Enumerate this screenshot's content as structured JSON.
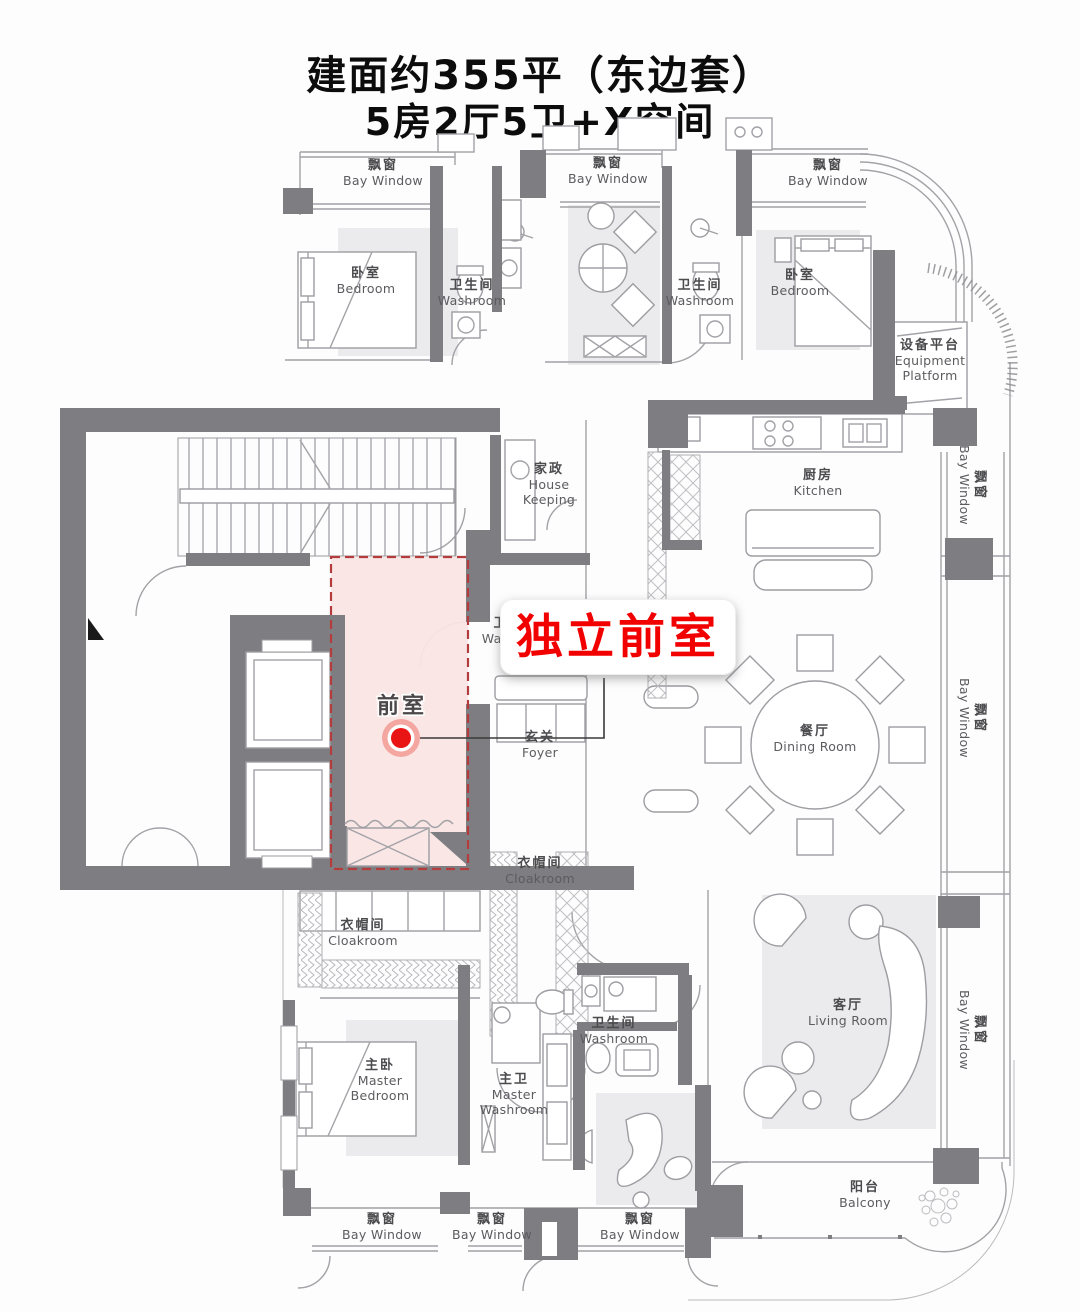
{
  "title": {
    "line1": "建面约355平（东边套）",
    "line2": "5房2厅5卫+X空间"
  },
  "callout": {
    "text": "独立前室"
  },
  "marker": {
    "label": "前室"
  },
  "rooms": [
    {
      "id": "bay-window-top-left",
      "zh": "飘窗",
      "en": "Bay Window"
    },
    {
      "id": "bay-window-top-middle",
      "zh": "飘窗",
      "en": "Bay Window"
    },
    {
      "id": "bay-window-top-right",
      "zh": "飘窗",
      "en": "Bay Window"
    },
    {
      "id": "bedroom-top-left",
      "zh": "卧室",
      "en": "Bedroom"
    },
    {
      "id": "washroom-top-left",
      "zh": "卫生间",
      "en": "Washroom"
    },
    {
      "id": "washroom-top-middle",
      "zh": "卫生间",
      "en": "Washroom"
    },
    {
      "id": "bedroom-top-right",
      "zh": "卧室",
      "en": "Bedroom"
    },
    {
      "id": "equipment-platform",
      "zh": "设备平台",
      "en": "Equipment Platform"
    },
    {
      "id": "bay-window-right-upper",
      "zh": "飘窗",
      "en": "Bay Window"
    },
    {
      "id": "house-keeping",
      "zh": "家政",
      "en": "House Keeping"
    },
    {
      "id": "kitchen",
      "zh": "厨房",
      "en": "Kitchen"
    },
    {
      "id": "washroom-middle",
      "zh": "卫生间",
      "en": "Washroom"
    },
    {
      "id": "foyer",
      "zh": "玄关",
      "en": "Foyer"
    },
    {
      "id": "dining-room",
      "zh": "餐厅",
      "en": "Dining Room"
    },
    {
      "id": "bay-window-right-middle",
      "zh": "飘窗",
      "en": "Bay Window"
    },
    {
      "id": "cloakroom-right",
      "zh": "衣帽间",
      "en": "Cloakroom"
    },
    {
      "id": "cloakroom-left",
      "zh": "衣帽间",
      "en": "Cloakroom"
    },
    {
      "id": "master-bedroom",
      "zh": "主卧",
      "en": "Master Bedroom"
    },
    {
      "id": "washroom-lower",
      "zh": "卫生间",
      "en": "Washroom"
    },
    {
      "id": "master-washroom",
      "zh": "主卫",
      "en": "Master Washroom"
    },
    {
      "id": "living-room",
      "zh": "客厅",
      "en": "Living Room"
    },
    {
      "id": "bay-window-right-lower",
      "zh": "飘窗",
      "en": "Bay Window"
    },
    {
      "id": "balcony",
      "zh": "阳台",
      "en": "Balcony"
    },
    {
      "id": "bay-window-bottom-left",
      "zh": "飘窗",
      "en": "Bay Window"
    },
    {
      "id": "bay-window-bottom-middle",
      "zh": "飘窗",
      "en": "Bay Window"
    },
    {
      "id": "bay-window-bottom-right",
      "zh": "飘窗",
      "en": "Bay Window"
    }
  ],
  "colors": {
    "wall": "#7e7e82",
    "wall_light": "#a9a9ad",
    "line": "#a2a2a7",
    "rug": "#ebebee",
    "highlight_fill": "#f9e5e4",
    "highlight_border": "#b43c3c",
    "marker_red": "#e91414",
    "marker_halo": "#f4a6a1",
    "callout_red": "#f20000",
    "text": "#4b4b4e"
  }
}
